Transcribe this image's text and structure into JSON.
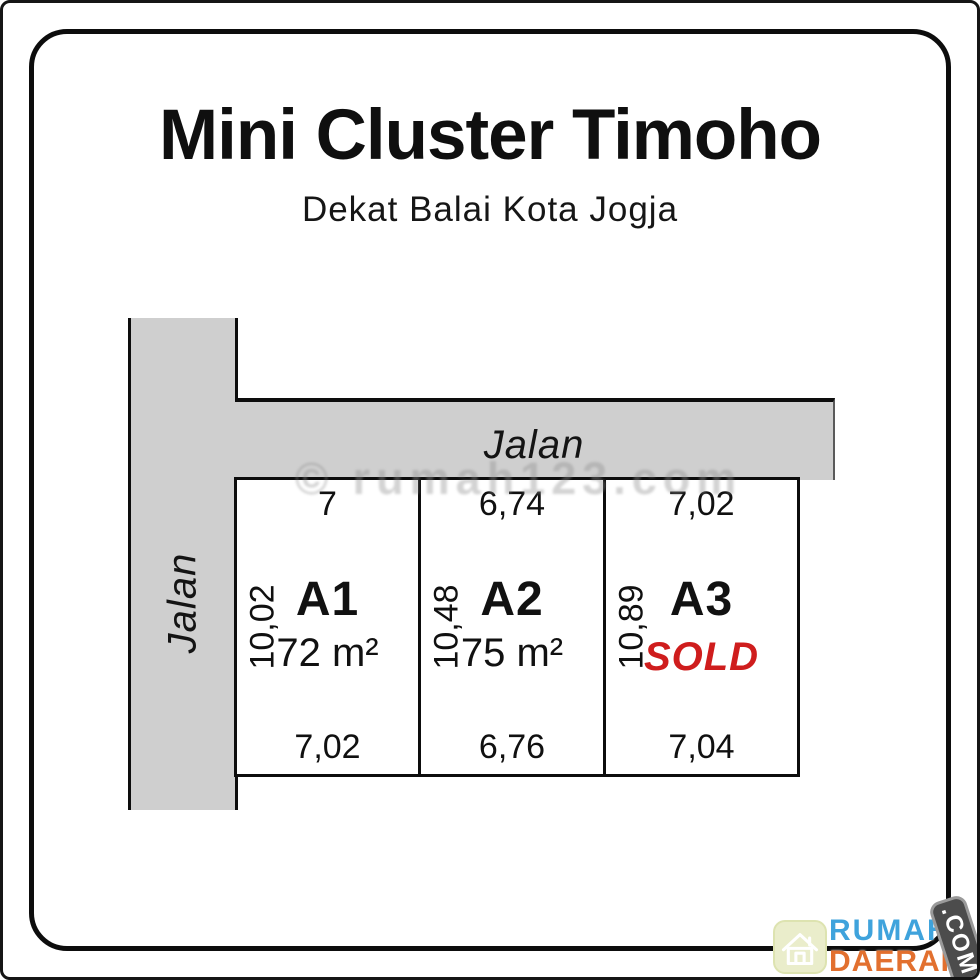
{
  "header": {
    "title": "Mini Cluster Timoho",
    "subtitle": "Dekat Balai Kota Jogja"
  },
  "roads": {
    "horizontal": {
      "label": "Jalan"
    },
    "vertical": {
      "label": "Jalan"
    }
  },
  "plots": [
    {
      "name": "A1",
      "top_dim": "7",
      "side_dim": "10,02",
      "bottom_dim": "7,02",
      "area": "72 m²",
      "status": ""
    },
    {
      "name": "A2",
      "top_dim": "6,74",
      "side_dim": "10,48",
      "bottom_dim": "6,76",
      "area": "75 m²",
      "status": ""
    },
    {
      "name": "A3",
      "top_dim": "7,02",
      "side_dim": "10,89",
      "bottom_dim": "7,04",
      "area": "",
      "status": "SOLD"
    }
  ],
  "watermark": {
    "text": "© rumah123.com"
  },
  "logo": {
    "name_top": "RUMAH",
    "name_bottom": "DAERAH",
    "badge": ".COM"
  },
  "colors": {
    "road": "#cfcfcf",
    "line": "#0d0d0d",
    "sold": "#cf1d1d",
    "logo_blue": "#3fa3dc",
    "logo_orange": "#e2702f",
    "badge_bg": "#4c4c4c",
    "house_bg": "#eaedcb"
  }
}
